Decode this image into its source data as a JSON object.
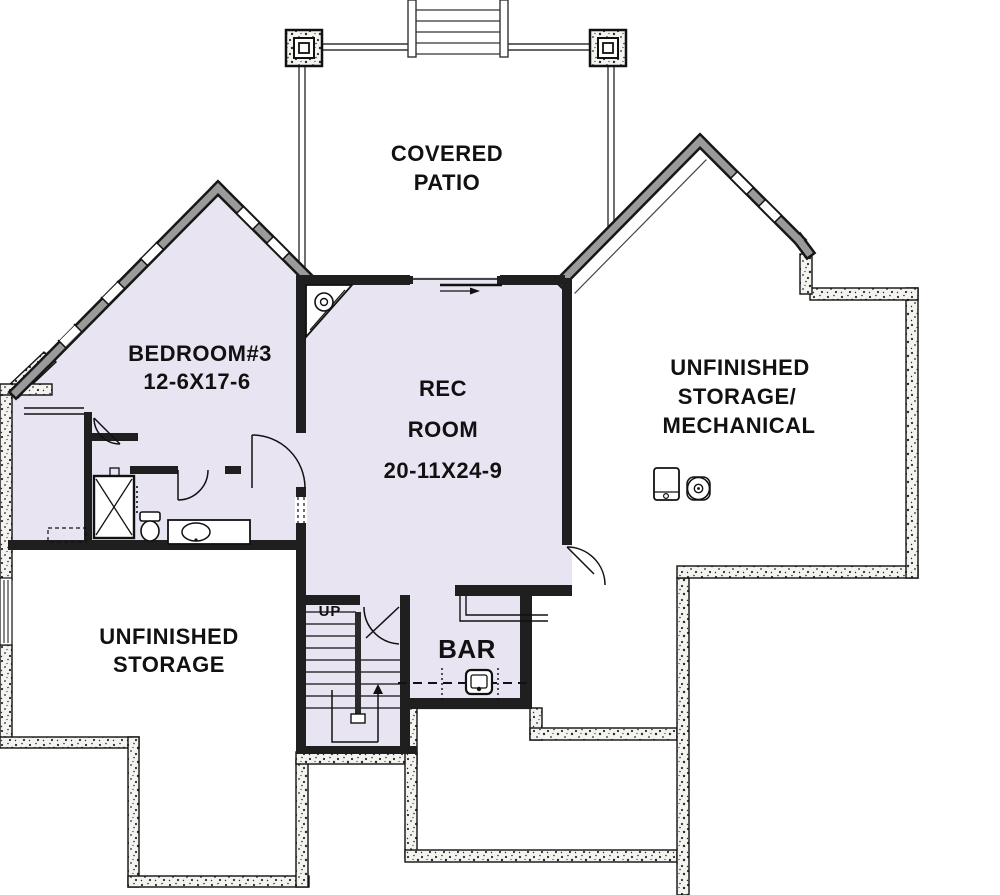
{
  "rooms": {
    "covered_patio": {
      "line1": "COVERED",
      "line2": "PATIO"
    },
    "bedroom_3": {
      "name": "BEDROOM#3",
      "dimensions": "12-6X17-6"
    },
    "rec_room": {
      "line1": "REC",
      "line2": "ROOM",
      "dimensions": "20-11X24-9"
    },
    "unfinished_storage_mechanical": {
      "line1": "UNFINISHED",
      "line2": "STORAGE/",
      "line3": "MECHANICAL"
    },
    "unfinished_storage": {
      "line1": "UNFINISHED",
      "line2": "STORAGE"
    },
    "bar": {
      "label": "BAR"
    },
    "stairs": {
      "label": "UP"
    }
  },
  "colors": {
    "finished_floor": "#e9e4f1",
    "wall": "#1f1f1f",
    "wall_gray": "#9a9a9a",
    "background": "#ffffff"
  },
  "fixtures": [
    "shower",
    "toilet",
    "vanity-sink",
    "closet-shelf",
    "corner-fireplace",
    "stairs-up",
    "bar-sink",
    "bar-counter",
    "furnace",
    "water-heater",
    "patio-column-left",
    "patio-column-right",
    "patio-steps",
    "sliding-door"
  ]
}
